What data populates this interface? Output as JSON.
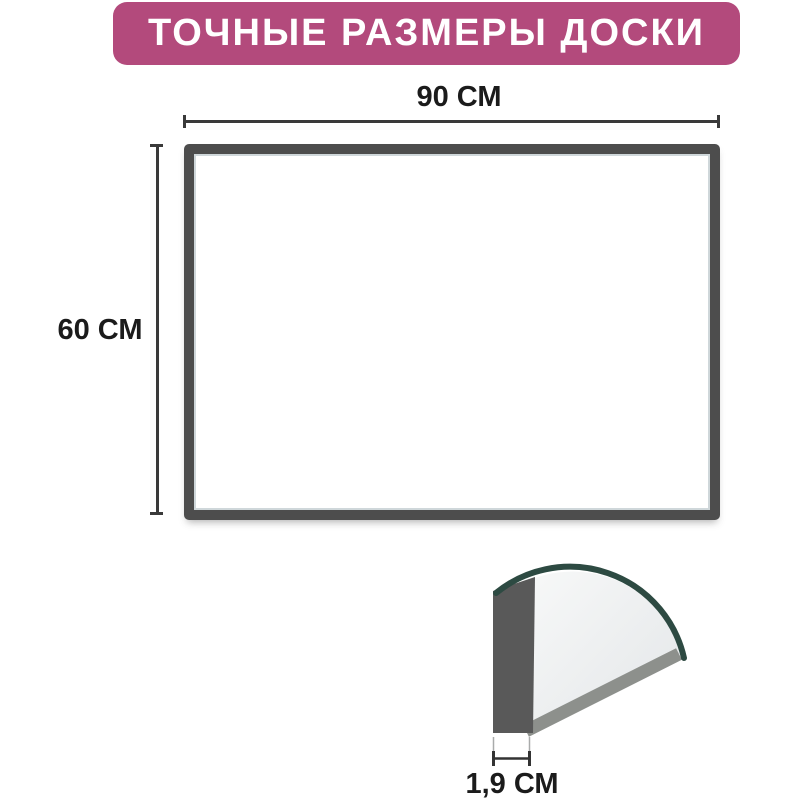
{
  "title": {
    "text": "ТОЧНЫЕ РАЗМЕРЫ ДОСКИ"
  },
  "dimensions": {
    "width": "90 СМ",
    "height": "60 СМ",
    "thickness": "1,9 СМ"
  },
  "colors": {
    "banner_bg": "#b34a7c",
    "banner_text": "#ffffff",
    "frame": "#4d4d4d",
    "dimension_line": "#3a3a3a",
    "label_text": "#1b1b1b",
    "edge_teal": "#2d4a42",
    "profile_gray": "#595959",
    "band_gray": "#8d908c",
    "surface_light": "#eef0f1",
    "extension_line": "#a9abab"
  }
}
